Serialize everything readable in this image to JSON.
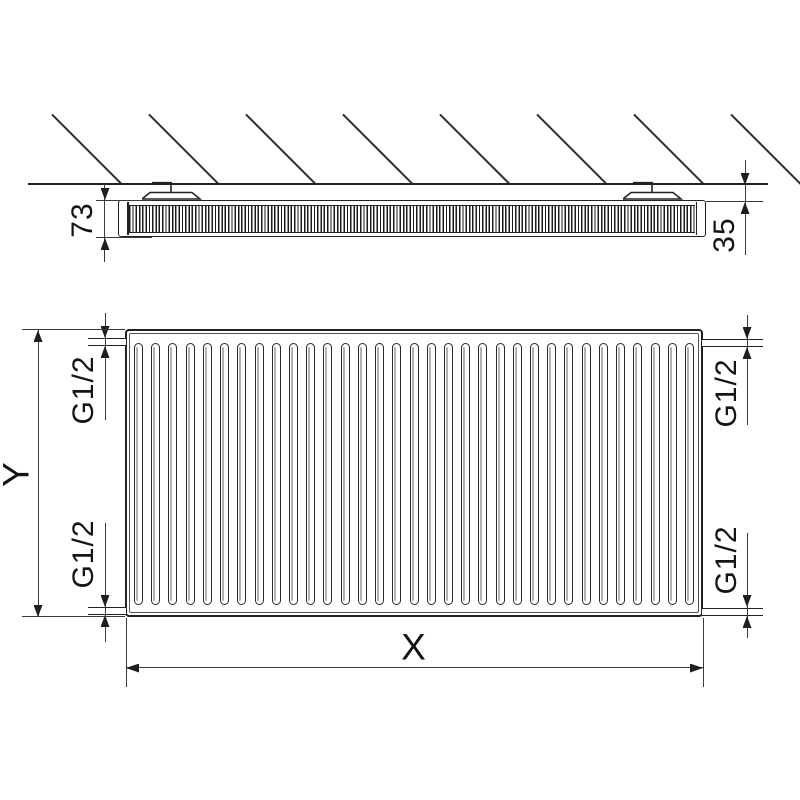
{
  "dimensions": {
    "depth": "73",
    "wall_distance": "35",
    "height": "Y",
    "width": "X",
    "connection": "G1/2"
  },
  "figure": {
    "front_fin_count": 33,
    "hatch_line_count": 8
  }
}
